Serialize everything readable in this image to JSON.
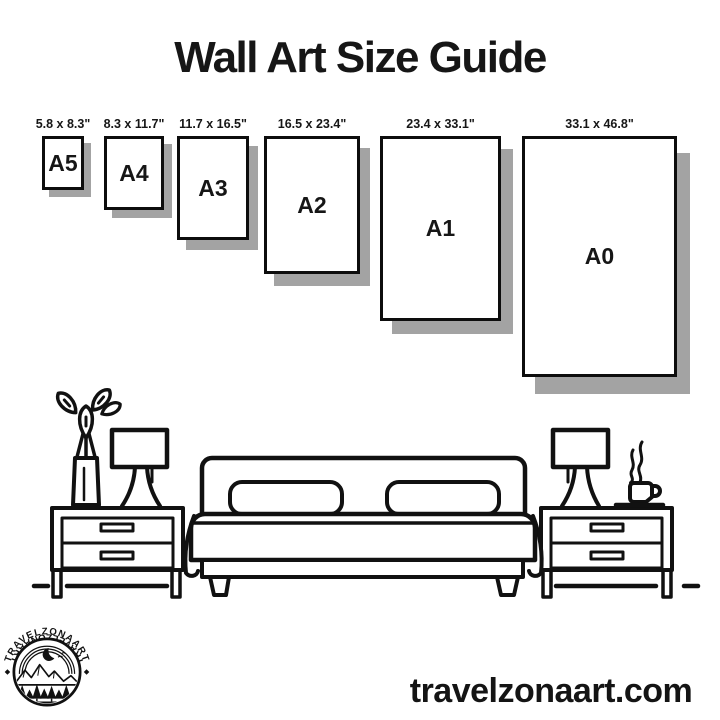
{
  "title": "Wall Art Size Guide",
  "sizes": [
    {
      "name": "A5",
      "dims": "5.8 x 8.3\""
    },
    {
      "name": "A4",
      "dims": "8.3 x 11.7\""
    },
    {
      "name": "A3",
      "dims": "11.7 x 16.5\""
    },
    {
      "name": "A2",
      "dims": "16.5 x 23.4\""
    },
    {
      "name": "A1",
      "dims": "23.4 x 33.1\""
    },
    {
      "name": "A0",
      "dims": "33.1 x 46.8\""
    }
  ],
  "logo": {
    "brand_top": "TRAVELZONAART",
    "brand_bottom": "TRAVELZONAART"
  },
  "footer": {
    "website": "travelzonaart.com"
  },
  "colors": {
    "ink": "#111111",
    "shadow": "#a3a3a3",
    "background": "#ffffff"
  }
}
